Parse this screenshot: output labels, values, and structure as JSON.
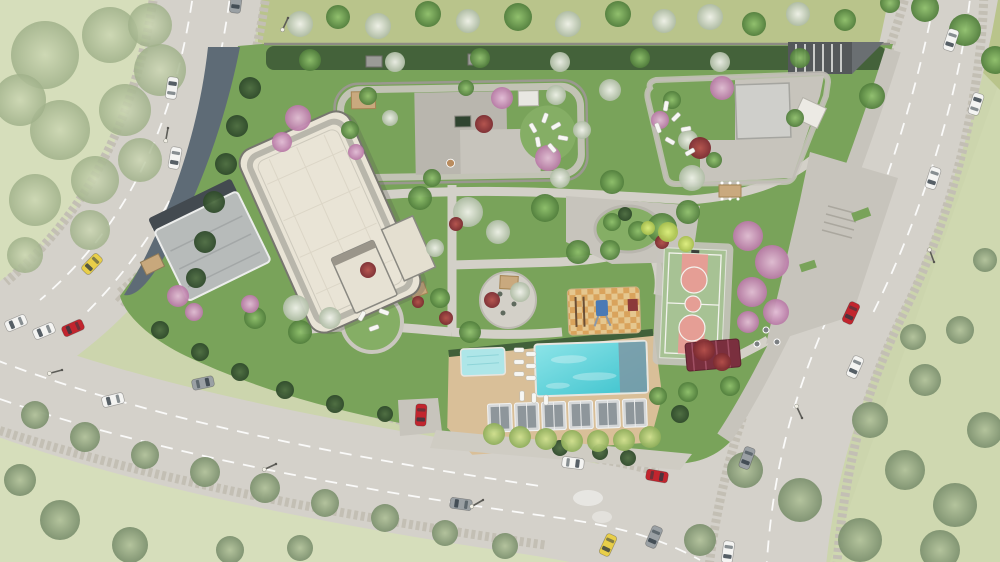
{
  "scene": {
    "description": "Aerial watercolor-style architectural rendering of a residential site plan: curving multi-lane roads around a landscaped complex with a large white apartment-building roof, two podium roof gardens, central gardens, swimming pool with deck and cabanas, basketball court, playground and surrounding meadows",
    "width": 1000,
    "height": 562,
    "visible_text": "none"
  },
  "palette": {
    "canvas": "#ccd5ad",
    "meadow_pale": "#d6debb",
    "meadow_right": "#cfd8b0",
    "grass_strip": "#b9c48b",
    "road": "#d4d1ca",
    "road_gravel": "#c3bfb4",
    "lane_line": "#ffffff",
    "site_lawn": "#79a35a",
    "lawn_light": "#85ae65",
    "hedge": "#415f39",
    "paving": "#c7c4bc",
    "paving_dark": "#b9b6ae",
    "path": "#d3d0c8",
    "slate": "#5e6b76",
    "canopy": "#b7bbba",
    "roof_cream": "#e9e4d6",
    "roof_edge": "#77766f",
    "parapet": "#b3b0a6",
    "pool_deck": "#d9bf98",
    "water_light": "#8ce4e8",
    "water": "#45c6d0",
    "kids_pool": "#aee6e8",
    "pool_slate": "#7d98a4",
    "court_green": "#a7c294",
    "court_key": "#e59e95",
    "court_line": "#f3f3ee",
    "cabana_frame": "#d6d8d9",
    "cabana_roof": "#8e969b",
    "pergola_maroon": "#7a2f3e",
    "pergola_tan": "#c9a97e",
    "ramp_dark": "#54585a",
    "wall": "#8d8b84",
    "cars": {
      "white": "#f4f4f2",
      "gray": "#9aa0a4",
      "red": "#c2252e",
      "yellow": "#e8ce49"
    },
    "trees": {
      "green": "#6f9c55",
      "dark": "#3c5a34",
      "pink": "#cf9cc2",
      "white": "#dde3d4",
      "red": "#96343a",
      "yellow": "#c9d96a",
      "sage": "#9cad87",
      "pale": "#bcc9a4",
      "deck": "#a8c273"
    }
  },
  "counts": {
    "cars": 22,
    "street_lamps": 7,
    "pool_cabanas": 6,
    "basketball_courts": 1,
    "playgrounds": 1
  },
  "pool": {
    "cabana_xs": [
      487,
      514,
      541,
      568,
      595,
      622
    ],
    "cabana_y": 402
  },
  "cars": [
    {
      "color": "gray",
      "x": 236,
      "y": 2,
      "rot": 187
    },
    {
      "color": "white",
      "x": 172,
      "y": 88,
      "rot": 8
    },
    {
      "color": "white",
      "x": 175,
      "y": 158,
      "rot": 190
    },
    {
      "color": "yellow",
      "x": 92,
      "y": 264,
      "rot": 224
    },
    {
      "color": "white",
      "x": 16,
      "y": 323,
      "rot": 247
    },
    {
      "color": "white",
      "x": 44,
      "y": 331,
      "rot": 247
    },
    {
      "color": "red",
      "x": 73,
      "y": 328,
      "rot": 246
    },
    {
      "color": "white",
      "x": 113,
      "y": 400,
      "rot": 256
    },
    {
      "color": "gray",
      "x": 203,
      "y": 383,
      "rot": 78
    },
    {
      "color": "red",
      "x": 421,
      "y": 415,
      "rot": 183
    },
    {
      "color": "white",
      "x": 573,
      "y": 463,
      "rot": 97
    },
    {
      "color": "gray",
      "x": 461,
      "y": 504,
      "rot": 278
    },
    {
      "color": "red",
      "x": 657,
      "y": 476,
      "rot": 100
    },
    {
      "color": "yellow",
      "x": 608,
      "y": 545,
      "rot": 205
    },
    {
      "color": "gray",
      "x": 654,
      "y": 537,
      "rot": 203
    },
    {
      "color": "red",
      "x": 851,
      "y": 313,
      "rot": 205
    },
    {
      "color": "white",
      "x": 855,
      "y": 367,
      "rot": 204
    },
    {
      "color": "gray",
      "x": 747,
      "y": 458,
      "rot": 200
    },
    {
      "color": "white",
      "x": 728,
      "y": 552,
      "rot": 188
    },
    {
      "color": "white",
      "x": 951,
      "y": 40,
      "rot": 198
    },
    {
      "color": "white",
      "x": 976,
      "y": 104,
      "rot": 18
    },
    {
      "color": "white",
      "x": 933,
      "y": 178,
      "rot": 198
    }
  ],
  "lamps": [
    {
      "x": 288,
      "y": 18,
      "rot": 115
    },
    {
      "x": 62,
      "y": 370,
      "rot": 165
    },
    {
      "x": 276,
      "y": 464,
      "rot": 155
    },
    {
      "x": 483,
      "y": 500,
      "rot": 150
    },
    {
      "x": 802,
      "y": 418,
      "rot": 245
    },
    {
      "x": 934,
      "y": 262,
      "rot": 250
    },
    {
      "x": 168,
      "y": 128,
      "rot": 100
    }
  ],
  "loungers": [
    {
      "x": 519,
      "y": 350,
      "rot": 90
    },
    {
      "x": 519,
      "y": 362,
      "rot": 90
    },
    {
      "x": 519,
      "y": 374,
      "rot": 90
    },
    {
      "x": 531,
      "y": 354,
      "rot": 90
    },
    {
      "x": 531,
      "y": 366,
      "rot": 90
    },
    {
      "x": 531,
      "y": 378,
      "rot": 90
    },
    {
      "x": 522,
      "y": 396,
      "rot": 0
    },
    {
      "x": 534,
      "y": 398,
      "rot": 0
    },
    {
      "x": 546,
      "y": 400,
      "rot": 0
    },
    {
      "x": 545,
      "y": 118,
      "rot": 20
    },
    {
      "x": 556,
      "y": 126,
      "rot": 60
    },
    {
      "x": 563,
      "y": 138,
      "rot": 100
    },
    {
      "x": 552,
      "y": 148,
      "rot": 140
    },
    {
      "x": 538,
      "y": 142,
      "rot": 170
    },
    {
      "x": 533,
      "y": 128,
      "rot": -30
    },
    {
      "x": 666,
      "y": 106,
      "rot": 10
    },
    {
      "x": 676,
      "y": 117,
      "rot": 45
    },
    {
      "x": 686,
      "y": 129,
      "rot": 80
    },
    {
      "x": 670,
      "y": 141,
      "rot": 120
    },
    {
      "x": 658,
      "y": 128,
      "rot": 160
    },
    {
      "x": 690,
      "y": 152,
      "rot": 60
    },
    {
      "x": 362,
      "y": 316,
      "rot": 30
    },
    {
      "x": 374,
      "y": 328,
      "rot": 70
    },
    {
      "x": 384,
      "y": 312,
      "rot": 110
    }
  ],
  "trees": [
    {
      "t": "pale",
      "x": 45,
      "y": 55,
      "r": 34
    },
    {
      "t": "pale",
      "x": 110,
      "y": 35,
      "r": 28
    },
    {
      "t": "pale",
      "x": 160,
      "y": 70,
      "r": 26
    },
    {
      "t": "pale",
      "x": 60,
      "y": 130,
      "r": 30
    },
    {
      "t": "pale",
      "x": 125,
      "y": 110,
      "r": 26
    },
    {
      "t": "pale",
      "x": 35,
      "y": 200,
      "r": 26
    },
    {
      "t": "pale",
      "x": 95,
      "y": 180,
      "r": 24
    },
    {
      "t": "pale",
      "x": 150,
      "y": 25,
      "r": 22
    },
    {
      "t": "pale",
      "x": 20,
      "y": 100,
      "r": 26
    },
    {
      "t": "pale",
      "x": 90,
      "y": 230,
      "r": 20
    },
    {
      "t": "pale",
      "x": 140,
      "y": 160,
      "r": 22
    },
    {
      "t": "pale",
      "x": 25,
      "y": 255,
      "r": 18
    },
    {
      "t": "sage",
      "x": 35,
      "y": 415,
      "r": 14
    },
    {
      "t": "sage",
      "x": 85,
      "y": 437,
      "r": 15
    },
    {
      "t": "sage",
      "x": 145,
      "y": 455,
      "r": 14
    },
    {
      "t": "sage",
      "x": 205,
      "y": 472,
      "r": 15
    },
    {
      "t": "sage",
      "x": 265,
      "y": 488,
      "r": 15
    },
    {
      "t": "sage",
      "x": 325,
      "y": 503,
      "r": 14
    },
    {
      "t": "sage",
      "x": 385,
      "y": 518,
      "r": 14
    },
    {
      "t": "sage",
      "x": 445,
      "y": 533,
      "r": 13
    },
    {
      "t": "sage",
      "x": 505,
      "y": 546,
      "r": 13
    },
    {
      "t": "sage",
      "x": 60,
      "y": 520,
      "r": 20
    },
    {
      "t": "sage",
      "x": 20,
      "y": 480,
      "r": 16
    },
    {
      "t": "sage",
      "x": 130,
      "y": 545,
      "r": 18
    },
    {
      "t": "sage",
      "x": 230,
      "y": 550,
      "r": 14
    },
    {
      "t": "sage",
      "x": 300,
      "y": 548,
      "r": 13
    },
    {
      "t": "sage",
      "x": 745,
      "y": 470,
      "r": 18
    },
    {
      "t": "sage",
      "x": 800,
      "y": 500,
      "r": 22
    },
    {
      "t": "sage",
      "x": 860,
      "y": 540,
      "r": 22
    },
    {
      "t": "sage",
      "x": 905,
      "y": 470,
      "r": 20
    },
    {
      "t": "sage",
      "x": 955,
      "y": 505,
      "r": 22
    },
    {
      "t": "sage",
      "x": 870,
      "y": 420,
      "r": 18
    },
    {
      "t": "sage",
      "x": 925,
      "y": 380,
      "r": 16
    },
    {
      "t": "sage",
      "x": 960,
      "y": 330,
      "r": 14
    },
    {
      "t": "sage",
      "x": 985,
      "y": 260,
      "r": 12
    },
    {
      "t": "sage",
      "x": 700,
      "y": 540,
      "r": 16
    },
    {
      "t": "sage",
      "x": 985,
      "y": 430,
      "r": 18
    },
    {
      "t": "sage",
      "x": 940,
      "y": 550,
      "r": 20
    },
    {
      "t": "sage",
      "x": 913,
      "y": 337,
      "r": 13
    },
    {
      "t": "green",
      "x": 925,
      "y": 8,
      "r": 14
    },
    {
      "t": "green",
      "x": 965,
      "y": 30,
      "r": 16
    },
    {
      "t": "green",
      "x": 995,
      "y": 60,
      "r": 14
    },
    {
      "t": "green",
      "x": 890,
      "y": 3,
      "r": 10
    },
    {
      "t": "white",
      "x": 300,
      "y": 24,
      "r": 13
    },
    {
      "t": "green",
      "x": 338,
      "y": 17,
      "r": 12
    },
    {
      "t": "white",
      "x": 378,
      "y": 26,
      "r": 13
    },
    {
      "t": "green",
      "x": 428,
      "y": 14,
      "r": 13
    },
    {
      "t": "white",
      "x": 468,
      "y": 21,
      "r": 12
    },
    {
      "t": "green",
      "x": 518,
      "y": 17,
      "r": 14
    },
    {
      "t": "white",
      "x": 568,
      "y": 24,
      "r": 13
    },
    {
      "t": "green",
      "x": 618,
      "y": 14,
      "r": 13
    },
    {
      "t": "white",
      "x": 664,
      "y": 21,
      "r": 12
    },
    {
      "t": "white",
      "x": 710,
      "y": 17,
      "r": 13
    },
    {
      "t": "green",
      "x": 754,
      "y": 24,
      "r": 12
    },
    {
      "t": "white",
      "x": 798,
      "y": 14,
      "r": 12
    },
    {
      "t": "green",
      "x": 845,
      "y": 20,
      "r": 11
    },
    {
      "t": "green",
      "x": 310,
      "y": 60,
      "r": 11
    },
    {
      "t": "white",
      "x": 395,
      "y": 62,
      "r": 10
    },
    {
      "t": "green",
      "x": 480,
      "y": 58,
      "r": 10
    },
    {
      "t": "white",
      "x": 560,
      "y": 62,
      "r": 10
    },
    {
      "t": "green",
      "x": 640,
      "y": 58,
      "r": 10
    },
    {
      "t": "white",
      "x": 720,
      "y": 62,
      "r": 10
    },
    {
      "t": "green",
      "x": 800,
      "y": 58,
      "r": 10
    },
    {
      "t": "dark",
      "x": 250,
      "y": 88,
      "r": 11
    },
    {
      "t": "dark",
      "x": 237,
      "y": 126,
      "r": 11
    },
    {
      "t": "dark",
      "x": 226,
      "y": 164,
      "r": 11
    },
    {
      "t": "dark",
      "x": 214,
      "y": 202,
      "r": 11
    },
    {
      "t": "dark",
      "x": 205,
      "y": 242,
      "r": 11
    },
    {
      "t": "dark",
      "x": 196,
      "y": 278,
      "r": 10
    },
    {
      "t": "dark",
      "x": 160,
      "y": 330,
      "r": 9
    },
    {
      "t": "dark",
      "x": 200,
      "y": 352,
      "r": 9
    },
    {
      "t": "dark",
      "x": 240,
      "y": 372,
      "r": 9
    },
    {
      "t": "dark",
      "x": 285,
      "y": 390,
      "r": 9
    },
    {
      "t": "dark",
      "x": 335,
      "y": 404,
      "r": 9
    },
    {
      "t": "dark",
      "x": 385,
      "y": 414,
      "r": 8
    },
    {
      "t": "dark",
      "x": 560,
      "y": 448,
      "r": 8
    },
    {
      "t": "dark",
      "x": 600,
      "y": 452,
      "r": 8
    },
    {
      "t": "dark",
      "x": 628,
      "y": 458,
      "r": 8
    },
    {
      "t": "dark",
      "x": 680,
      "y": 414,
      "r": 9
    },
    {
      "t": "green",
      "x": 420,
      "y": 198,
      "r": 12
    },
    {
      "t": "green",
      "x": 545,
      "y": 208,
      "r": 14
    },
    {
      "t": "green",
      "x": 612,
      "y": 182,
      "r": 12
    },
    {
      "t": "green",
      "x": 662,
      "y": 228,
      "r": 15
    },
    {
      "t": "green",
      "x": 440,
      "y": 298,
      "r": 10
    },
    {
      "t": "green",
      "x": 470,
      "y": 332,
      "r": 11
    },
    {
      "t": "green",
      "x": 578,
      "y": 252,
      "r": 12
    },
    {
      "t": "green",
      "x": 688,
      "y": 212,
      "r": 12
    },
    {
      "t": "green",
      "x": 432,
      "y": 178,
      "r": 9
    },
    {
      "t": "green",
      "x": 300,
      "y": 332,
      "r": 12
    },
    {
      "t": "green",
      "x": 255,
      "y": 318,
      "r": 11
    },
    {
      "t": "green",
      "x": 610,
      "y": 250,
      "r": 10
    },
    {
      "t": "green",
      "x": 688,
      "y": 392,
      "r": 10
    },
    {
      "t": "green",
      "x": 658,
      "y": 396,
      "r": 9
    },
    {
      "t": "green",
      "x": 730,
      "y": 386,
      "r": 10
    },
    {
      "t": "green",
      "x": 368,
      "y": 96,
      "r": 9
    },
    {
      "t": "green",
      "x": 350,
      "y": 130,
      "r": 9
    },
    {
      "t": "green",
      "x": 466,
      "y": 88,
      "r": 8
    },
    {
      "t": "green",
      "x": 672,
      "y": 100,
      "r": 9
    },
    {
      "t": "green",
      "x": 714,
      "y": 160,
      "r": 8
    },
    {
      "t": "green",
      "x": 612,
      "y": 222,
      "r": 9
    },
    {
      "t": "green",
      "x": 638,
      "y": 231,
      "r": 10
    },
    {
      "t": "dark",
      "x": 625,
      "y": 214,
      "r": 7
    },
    {
      "t": "white",
      "x": 468,
      "y": 212,
      "r": 15
    },
    {
      "t": "white",
      "x": 498,
      "y": 232,
      "r": 12
    },
    {
      "t": "white",
      "x": 560,
      "y": 178,
      "r": 10
    },
    {
      "t": "white",
      "x": 296,
      "y": 308,
      "r": 13
    },
    {
      "t": "white",
      "x": 330,
      "y": 318,
      "r": 11
    },
    {
      "t": "white",
      "x": 692,
      "y": 178,
      "r": 13
    },
    {
      "t": "white",
      "x": 520,
      "y": 292,
      "r": 10
    },
    {
      "t": "white",
      "x": 435,
      "y": 248,
      "r": 9
    },
    {
      "t": "white",
      "x": 556,
      "y": 95,
      "r": 10
    },
    {
      "t": "white",
      "x": 610,
      "y": 90,
      "r": 11
    },
    {
      "t": "white",
      "x": 688,
      "y": 140,
      "r": 10
    },
    {
      "t": "white",
      "x": 582,
      "y": 130,
      "r": 9
    },
    {
      "t": "white",
      "x": 390,
      "y": 118,
      "r": 8
    },
    {
      "t": "pink",
      "x": 298,
      "y": 118,
      "r": 13
    },
    {
      "t": "pink",
      "x": 282,
      "y": 142,
      "r": 10
    },
    {
      "t": "pink",
      "x": 502,
      "y": 98,
      "r": 11
    },
    {
      "t": "pink",
      "x": 548,
      "y": 158,
      "r": 13
    },
    {
      "t": "pink",
      "x": 722,
      "y": 88,
      "r": 12
    },
    {
      "t": "pink",
      "x": 178,
      "y": 296,
      "r": 11
    },
    {
      "t": "pink",
      "x": 194,
      "y": 312,
      "r": 9
    },
    {
      "t": "pink",
      "x": 748,
      "y": 236,
      "r": 15
    },
    {
      "t": "pink",
      "x": 772,
      "y": 262,
      "r": 17
    },
    {
      "t": "pink",
      "x": 752,
      "y": 292,
      "r": 15
    },
    {
      "t": "pink",
      "x": 776,
      "y": 312,
      "r": 13
    },
    {
      "t": "pink",
      "x": 748,
      "y": 322,
      "r": 11
    },
    {
      "t": "pink",
      "x": 660,
      "y": 120,
      "r": 9
    },
    {
      "t": "pink",
      "x": 356,
      "y": 152,
      "r": 8
    },
    {
      "t": "pink",
      "x": 250,
      "y": 304,
      "r": 9
    },
    {
      "t": "red",
      "x": 484,
      "y": 124,
      "r": 9
    },
    {
      "t": "red",
      "x": 456,
      "y": 224,
      "r": 7
    },
    {
      "t": "red",
      "x": 492,
      "y": 300,
      "r": 8
    },
    {
      "t": "red",
      "x": 700,
      "y": 148,
      "r": 11
    },
    {
      "t": "red",
      "x": 704,
      "y": 350,
      "r": 11
    },
    {
      "t": "red",
      "x": 722,
      "y": 362,
      "r": 9
    },
    {
      "t": "red",
      "x": 446,
      "y": 318,
      "r": 7
    },
    {
      "t": "red",
      "x": 418,
      "y": 302,
      "r": 6
    },
    {
      "t": "red",
      "x": 662,
      "y": 242,
      "r": 7
    },
    {
      "t": "red",
      "x": 368,
      "y": 270,
      "r": 8
    },
    {
      "t": "yellow",
      "x": 668,
      "y": 232,
      "r": 10
    },
    {
      "t": "yellow",
      "x": 686,
      "y": 244,
      "r": 8
    },
    {
      "t": "yellow",
      "x": 648,
      "y": 228,
      "r": 7
    },
    {
      "t": "deck",
      "x": 494,
      "y": 434,
      "r": 11
    },
    {
      "t": "deck",
      "x": 520,
      "y": 437,
      "r": 11
    },
    {
      "t": "deck",
      "x": 546,
      "y": 439,
      "r": 11
    },
    {
      "t": "deck",
      "x": 572,
      "y": 441,
      "r": 11
    },
    {
      "t": "deck",
      "x": 598,
      "y": 441,
      "r": 11
    },
    {
      "t": "deck",
      "x": 624,
      "y": 440,
      "r": 11
    },
    {
      "t": "deck",
      "x": 650,
      "y": 437,
      "r": 11
    },
    {
      "t": "green",
      "x": 872,
      "y": 96,
      "r": 13
    },
    {
      "t": "green",
      "x": 795,
      "y": 118,
      "r": 9
    }
  ]
}
